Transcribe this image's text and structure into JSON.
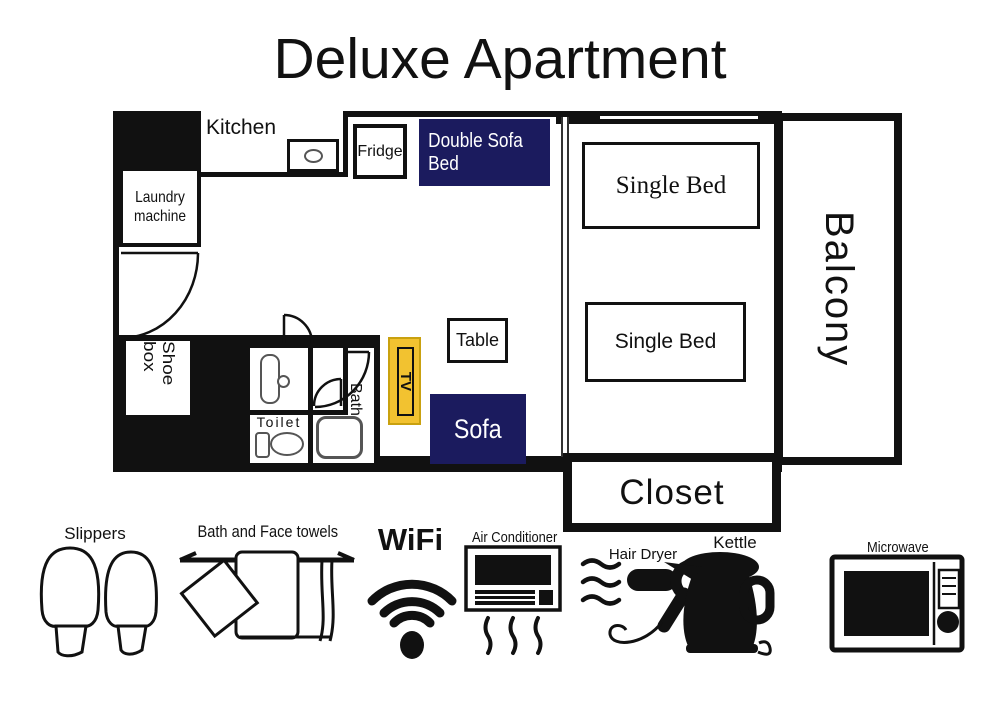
{
  "title": "Deluxe Apartment",
  "colors": {
    "navy": "#1b1b5e",
    "yellow": "#f2c230",
    "black": "#111111"
  },
  "floorplan": {
    "kitchen": "Kitchen",
    "fridge": "Fridge",
    "double_sofa_bed": "Double Sofa Bed",
    "single_bed_top": "Single Bed",
    "single_bed_bottom": "Single Bed",
    "balcony": "Balcony",
    "laundry_machine": "Laundry machine",
    "shoe_box": "Shoe box",
    "toilet": "Toilet",
    "bath": "Bath",
    "tv": "TV",
    "table": "Table",
    "sofa": "Sofa",
    "closet": "Closet"
  },
  "amenities": {
    "slippers": "Slippers",
    "towels": "Bath and Face towels",
    "wifi": "WiFi",
    "air_conditioner": "Air Conditioner",
    "hair_dryer": "Hair Dryer",
    "kettle": "Kettle",
    "microwave": "Microwave"
  }
}
